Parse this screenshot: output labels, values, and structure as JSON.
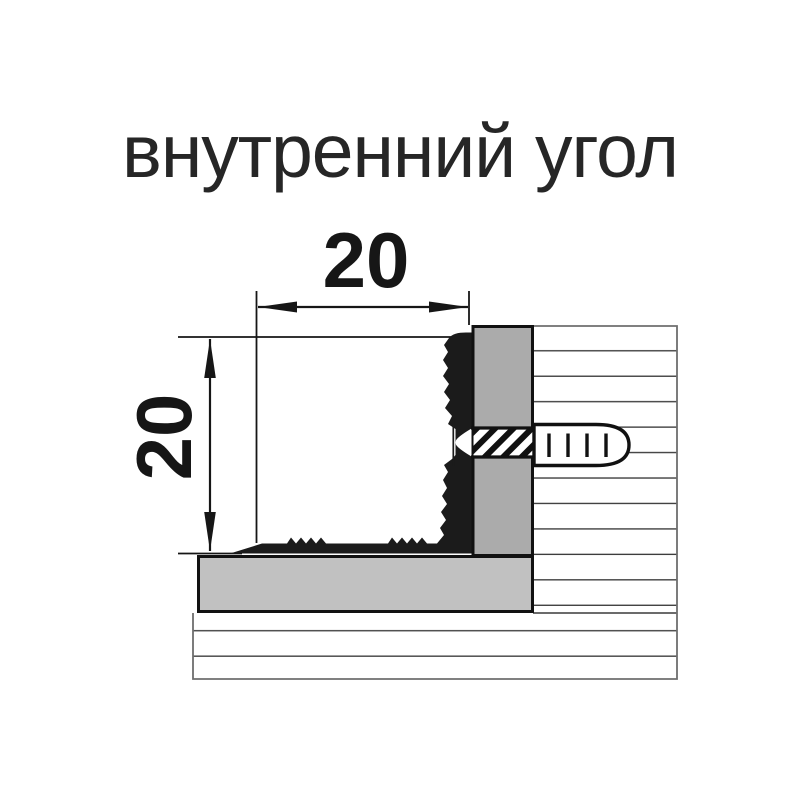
{
  "title": {
    "text": "внутренний угол"
  },
  "drawing": {
    "width_dimension": {
      "label": "20"
    },
    "height_dimension": {
      "label": "20"
    }
  },
  "colors": {
    "ink": "#161616",
    "profile_black": "#1b1b1b",
    "mounting_block_gray": "#ababab",
    "base_strip_gray": "#c1c1c1",
    "wall_line": "#3a3a3a",
    "wall_border": "#6e6e6e",
    "background": "#ffffff"
  }
}
